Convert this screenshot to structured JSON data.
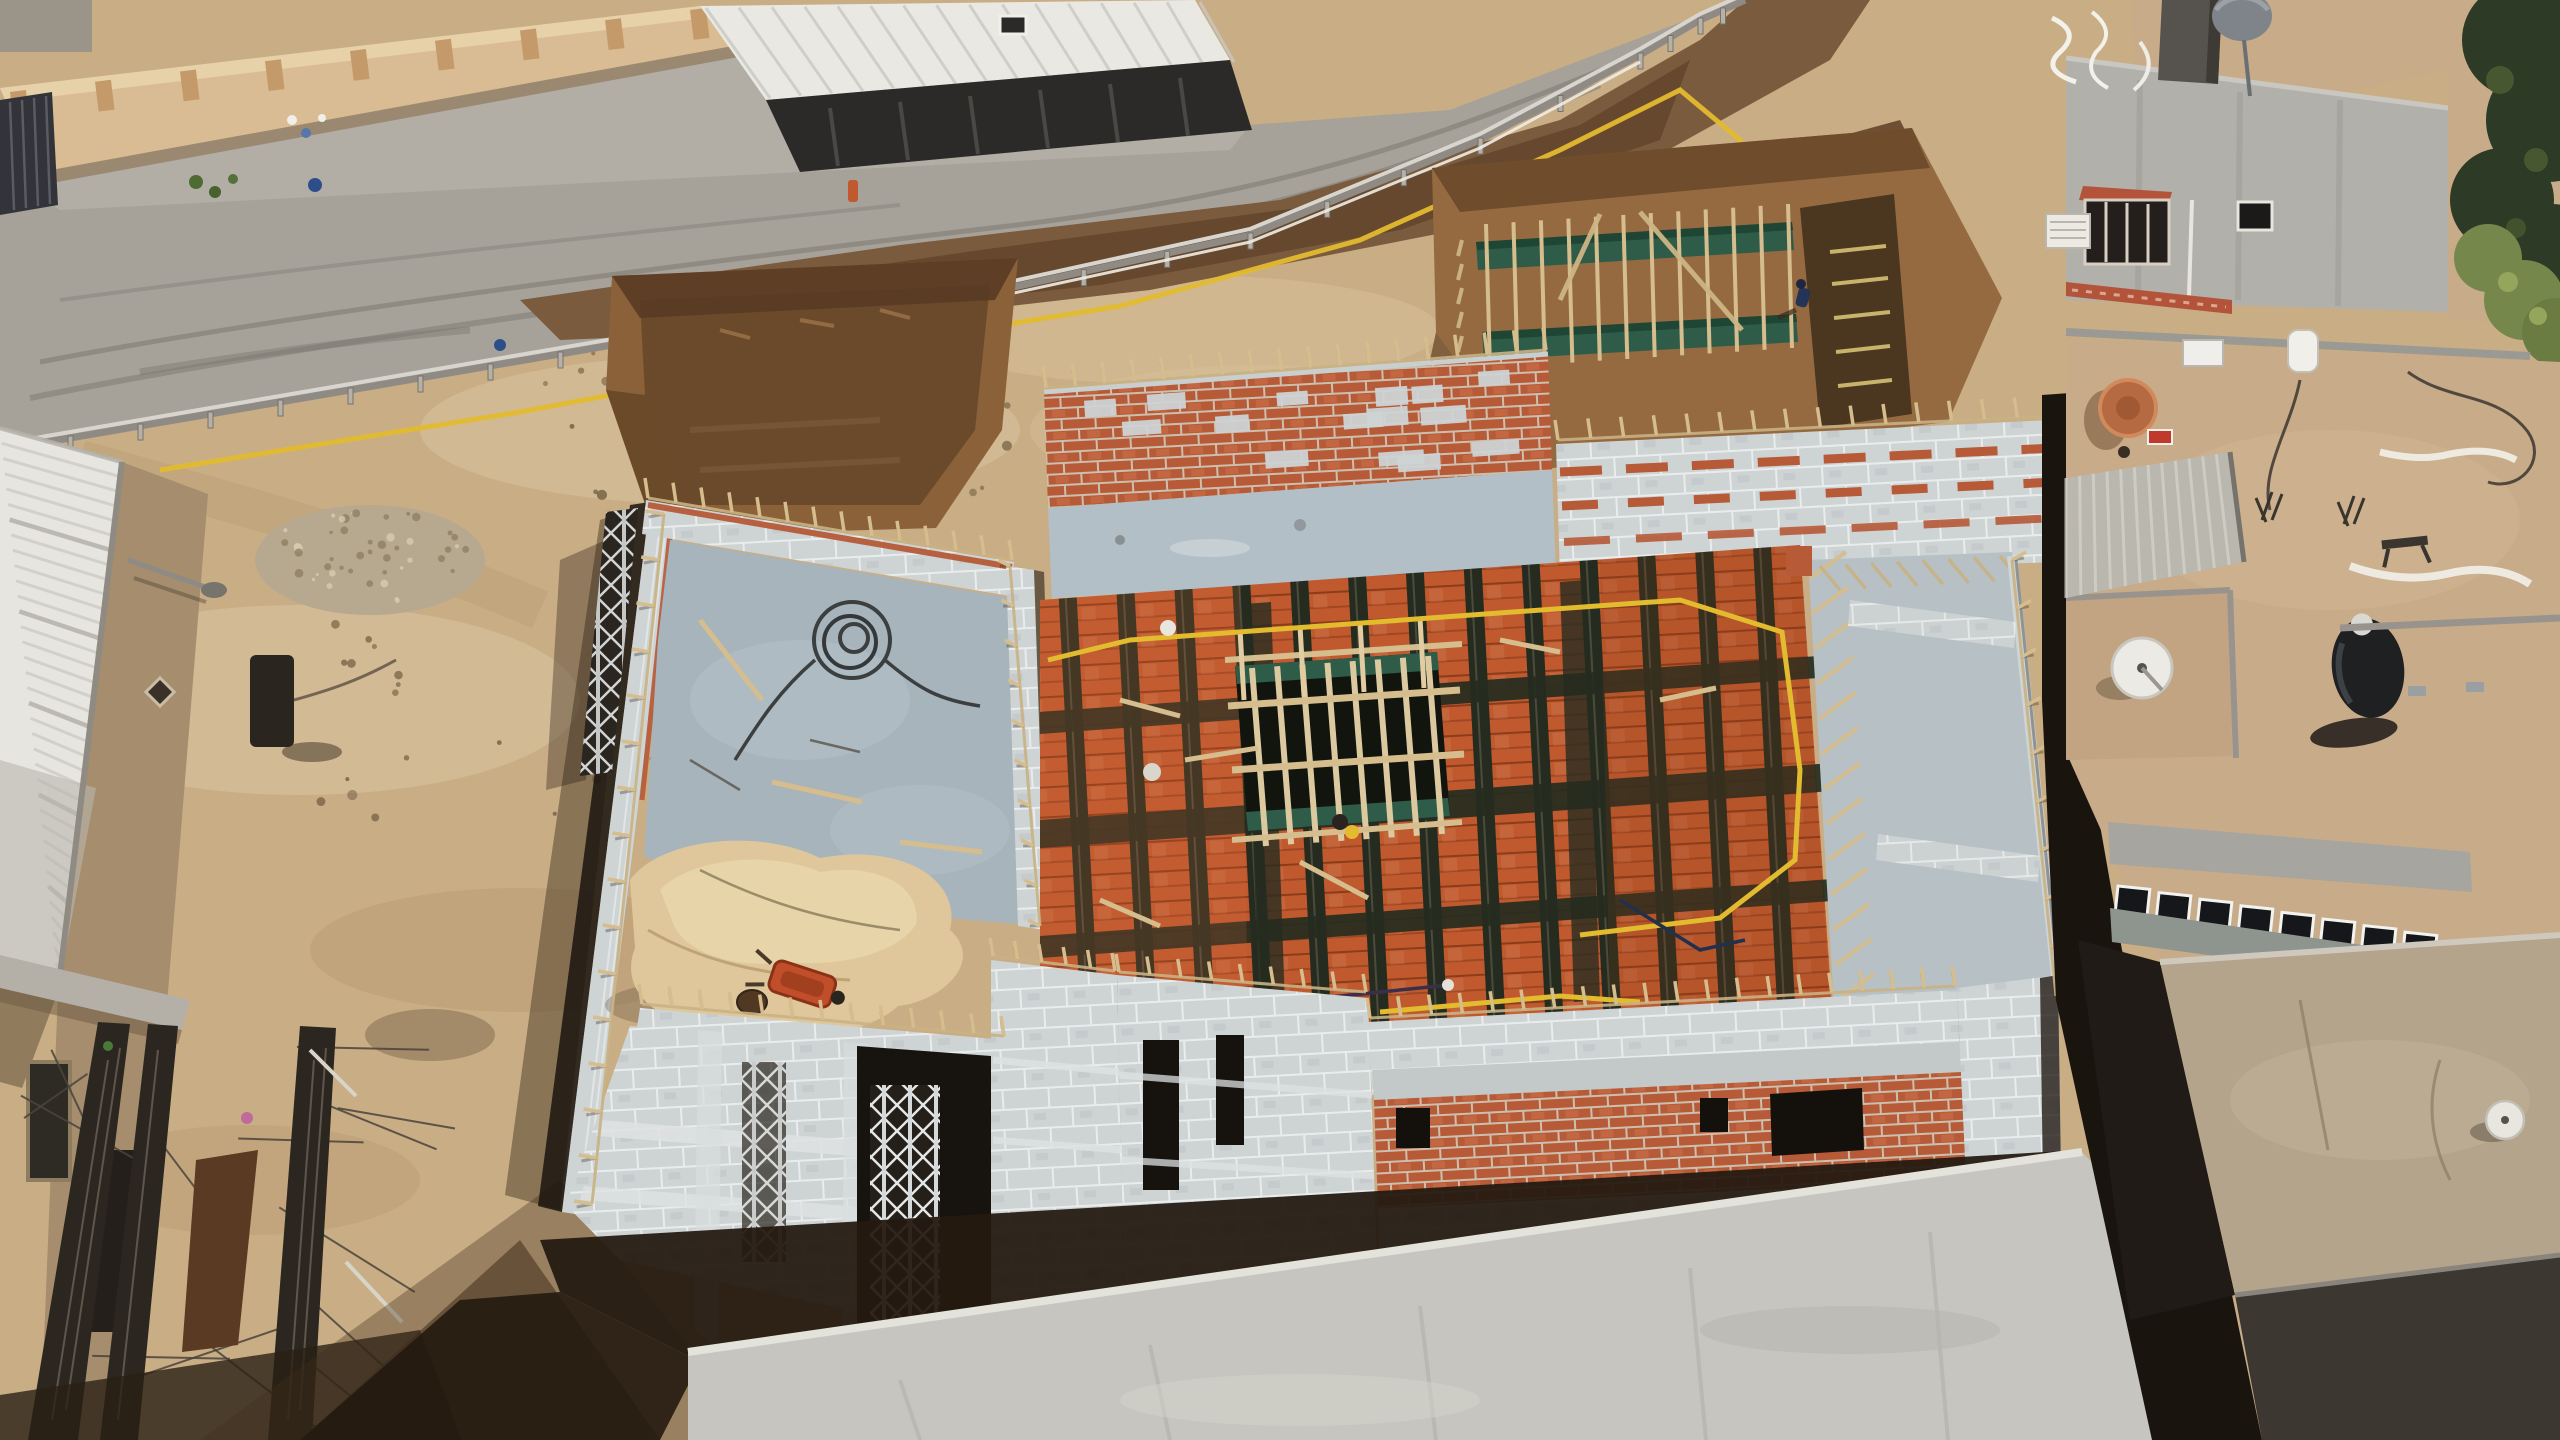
{
  "scene": {
    "type": "aerial-drone-photo",
    "description": "Aerial drone view of a building under construction: concrete-block walls with red brick bands, a floor-slab formwork of orange hollow clay blocks and rebar joists with a timber stairwell grid, excavation pits with green grade-beam formwork, a sandy site beside an unpaved road with a guardrail and wet mud, rebar bundles, scaffolding towers, and neighboring flat-roofed houses with water tanks, satellite dishes and trees.",
    "labels": {
      "road": "Unpaved road with wet mud patch and tire tracks",
      "boundary_wall": "Beige perimeter wall with pilasters and metal gate",
      "shed": "Shed with white corrugated roof and dark shopfront",
      "guardrail": "Road guardrail with posts",
      "yellow_hose": "Yellow hose running along the rail and across the slab",
      "excavation_pit": "Excavated foundation pit",
      "formwork_pit": "Foundation pit with green grade-beam formwork and a worker",
      "worker": "Worker in dark clothing",
      "main_building": "Building under construction with block walls and brick bands",
      "slab_formwork": "Slab formwork of orange hollow clay blocks and dark rebar joists",
      "stair_opening": "Stairwell opening with timber formwork grid",
      "sand_pile": "Sand heap with orange wheelbarrow and barrel",
      "cable_coil": "Coil of dark cable on the concrete slab",
      "scaffold_towers": "Metal scaffolding towers",
      "rebar_stacks": "Bundles of steel rebar on sandy ground",
      "left_building": "Warehouse with white corrugated roof",
      "right_buildings": "Neighboring flat-roofed houses",
      "water_tank_black": "Black rooftop water tank",
      "water_tank_gray": "Gray rooftop water tank",
      "satellite_dish_orange": "Orange satellite dish",
      "satellite_dish_white": "White satellite dish",
      "ac_unit": "Rooftop air-conditioner unit",
      "trees": "Trees along the right edge",
      "foreground_wall": "Light plastered boundary wall in the foreground",
      "alley_shadow": "Deep shadow in the alley between buildings",
      "ground_shadow": "Building shadow with stacked timber and green-wrapped bundles"
    },
    "palette": {
      "sand": "#c9ad85",
      "sand_light": "#dcc7a3",
      "sand_dark": "#b3966e",
      "road": "#a6a29a",
      "road_light": "#b8b4ab",
      "mud": "#7b5b3d",
      "mud_dark": "#5e4128",
      "pit_dirt": "#956a40",
      "pit_dark": "#6e4c2c",
      "pit_deep": "#4b3620",
      "block": "#ced3d4",
      "block_shade": "#aab0b2",
      "mortar": "#e9ecec",
      "slab": "#a7b4bc",
      "slab_light": "#b3bfc6",
      "brick": "#b65a38",
      "brick_light": "#c96f47",
      "form_orange": "#c05a2e",
      "joist": "#252c1f",
      "timber": "#d6bd8d",
      "timber_dark": "#b29367",
      "green_board": "#2f5c48",
      "green_wrap": "#27513b",
      "white": "#f0efe9",
      "tan_roof": "#c8ab88",
      "concrete": "#b2b0aa",
      "tree_dark": "#2c3a26",
      "tree_light": "#75874a",
      "shadow": "#1a140e",
      "yellow": "#e3bb2f",
      "blue": "#2c4f8a",
      "tank_black": "#1e2021",
      "tank_gray": "#7e8489",
      "steel": "#2c2620",
      "rust": "#5a3a22",
      "orange_dish": "#b66a42",
      "red_tile": "#b3543a",
      "gate": "#33343a"
    },
    "counts": {
      "scaffold_towers": 3,
      "clerestory_windows": 8,
      "rebar_bundles": 3,
      "satellite_dishes": 3,
      "water_tanks": 2,
      "excavation_pits": 2
    }
  }
}
